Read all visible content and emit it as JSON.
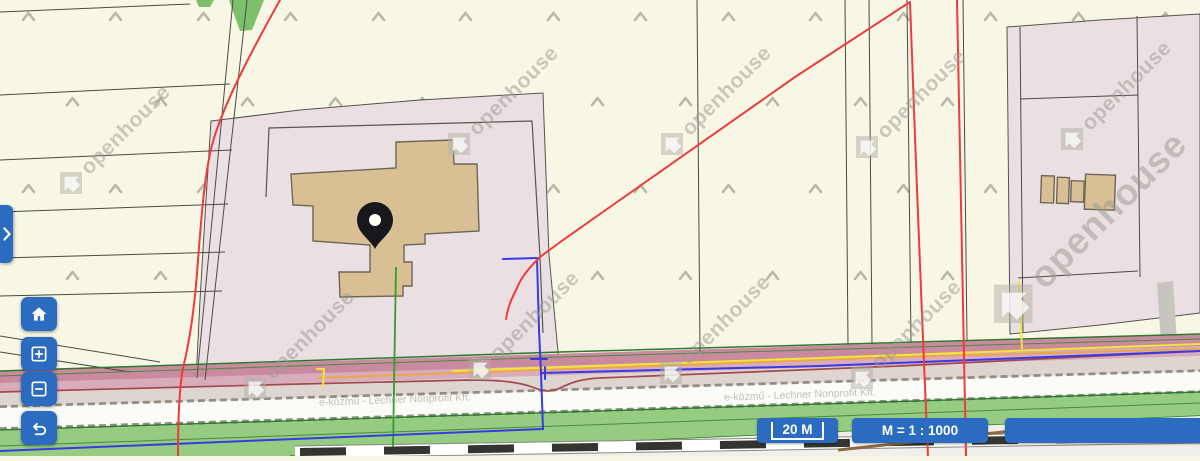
{
  "app": {
    "name": "cadastral-map-viewer"
  },
  "map": {
    "watermark_text": "openhouse",
    "attribution_text": "e-közmű - Lechner Nonprofit Kft.",
    "marker": {
      "type": "location-pin"
    },
    "colors": {
      "ui_blue": "#2b6bc0",
      "cream": "#f8f7e6",
      "parcel_pink": "#eae0e3",
      "building_tan": "#d8c094",
      "road_pink": "#c9899f",
      "green_strip": "#95cc82",
      "line_red": "#ee3b3b",
      "line_blue": "#3939e6",
      "line_green": "#2da02d",
      "line_yellow": "#f2e43c",
      "line_orange": "#eda73f",
      "line_darkred": "#a34a50"
    }
  },
  "controls": {
    "panel_toggle_icon": "chevron-right",
    "home_icon": "home",
    "zoom_in_icon": "plus-square",
    "zoom_out_icon": "minus-square",
    "undo_icon": "undo-arrow"
  },
  "statusbar": {
    "scale_bar_label": "20 M",
    "scale_ratio_label": "M = 1 : 1000"
  }
}
